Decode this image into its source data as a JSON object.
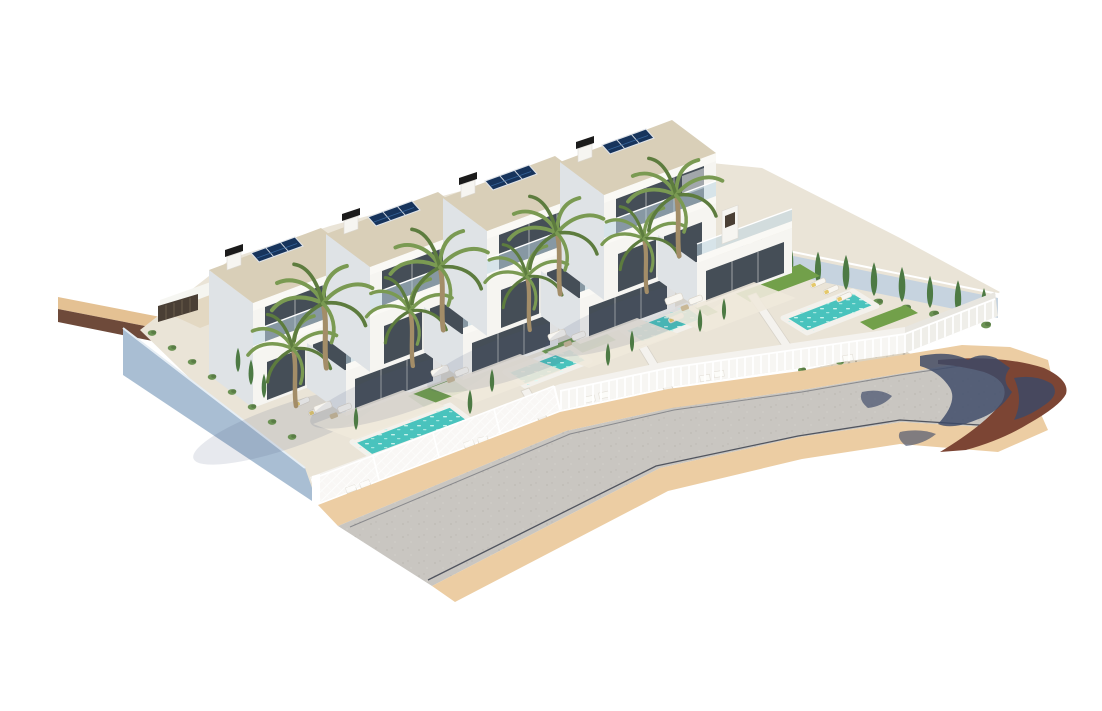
{
  "scene": {
    "type": "3d-architectural-render",
    "description": "Aerial isometric rendering of a residential development: four modern two-storey white villas in a stepped row, each with rooftop solar panels, chimney, balcony, covered terrace, palm trees, private turquoise pool, lawn patches and white perimeter fences; a curving asphalt road with tan sidewalks runs along the front, a pale blue retaining wall closes the left side and a red-brown dirt lot with tree shadows lies at the right road end.",
    "villa_count": 4,
    "villas": [
      {
        "id": "villa-1",
        "features": [
          "solar-panels",
          "chimney",
          "balcony",
          "covered-terrace",
          "pool",
          "lawn",
          "palm-trees",
          "sun-loungers",
          "lattice-fence"
        ]
      },
      {
        "id": "villa-2",
        "features": [
          "solar-panels",
          "chimney",
          "balcony",
          "covered-terrace",
          "pool",
          "lawn",
          "palm-trees",
          "sun-loungers",
          "railing-fence"
        ]
      },
      {
        "id": "villa-3",
        "features": [
          "solar-panels",
          "chimney",
          "balcony",
          "covered-terrace",
          "pool",
          "lawn",
          "palm-trees",
          "sun-loungers",
          "railing-fence"
        ]
      },
      {
        "id": "villa-4",
        "features": [
          "solar-panels",
          "chimney",
          "balcony",
          "covered-terrace",
          "pool",
          "lawn",
          "palm-trees",
          "sun-loungers",
          "railing-fence",
          "cypress-hedge",
          "corner-garden"
        ]
      }
    ],
    "environment": [
      "road",
      "sidewalks",
      "dirt-lot",
      "tree-shadows",
      "retaining-wall",
      "perimeter-fences",
      "gravel-rockery",
      "shrubs"
    ]
  },
  "colors": {
    "bg": "#ffffff",
    "villa_white": "#f6f5f1",
    "villa_shade": "#dfe3e6",
    "villa_shade_dark": "#cfd5d9",
    "roof_beige": "#d9cfb8",
    "fascia": "#faf9f5",
    "window_dark": "#454e57",
    "glass_rail": "rgba(190,214,226,0.55)",
    "solar_dark": "#17345c",
    "solar_grid": "#d7dde5",
    "chimney_dark": "#1b1b1b",
    "terrace_floor": "#efe9dc",
    "garden_ground": "#eae4d7",
    "pool_water": "#49c3bd",
    "pool_light": "#aee8e1",
    "pool_deck": "#f3f1ec",
    "lawn": "#72a04a",
    "lawn_dark": "#5f8c3c",
    "palm_green": "#7a9a52",
    "palm_dark": "#5d7c3e",
    "palm_trunk": "#a38d68",
    "cypress": "#4d7a44",
    "bush": "#6c9355",
    "wall_blue": "#a9bed3",
    "wall_blue_light": "#c6d3df",
    "fence_white": "#f4f2ee",
    "road_gray": "#c9c6c1",
    "road_line": "#3c414d",
    "sidewalk_tan": "#eccda3",
    "dirt_brown": "#7c4534",
    "shadow_navy": "#3c4968",
    "backdrop_tan": "#e4c193",
    "backdrop_brown": "#6e4a3a",
    "wood_dark": "#4a3f35",
    "furniture_white": "#f8f6f1",
    "cushion_yellow": "#e4c86a"
  }
}
